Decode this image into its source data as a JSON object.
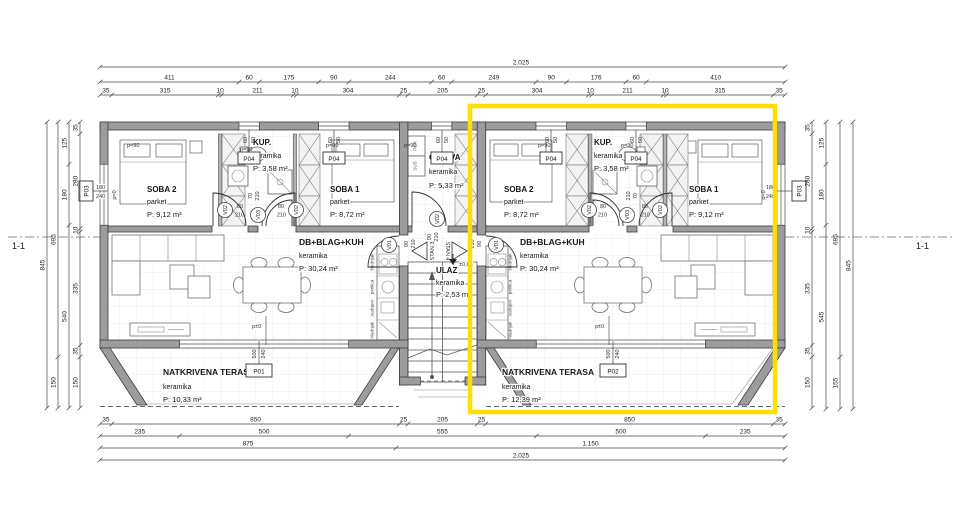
{
  "section": {
    "label": "1-1"
  },
  "highlight": {
    "color": "#ffdf00"
  },
  "rooms": {
    "l_soba2": {
      "name": "SOBA 2",
      "floor": "parket",
      "area": "P: 9,12 m²"
    },
    "l_kup": {
      "name": "KUP.",
      "floor": "keramika",
      "area": "P: 3,58 m²"
    },
    "l_soba1": {
      "name": "SOBA 1",
      "floor": "parket",
      "area": "P: 8,72 m²"
    },
    "l_living": {
      "name": "DB+BLAG+KUH",
      "floor": "keramika",
      "area": "P: 30,24 m²"
    },
    "l_terrace": {
      "name": "NATKRIVENA TERASA",
      "floor": "keramika",
      "area": "P: 10,33 m²"
    },
    "ostava": {
      "name": "OSTAVA",
      "floor": "keramika",
      "area": "P: 5,33 m²"
    },
    "ulaz": {
      "name": "ULAZ",
      "floor": "keramika",
      "area": "P: 2,53 m²"
    },
    "r_soba2": {
      "name": "SOBA 2",
      "floor": "parket",
      "area": "P: 8,72 m²"
    },
    "r_kup": {
      "name": "KUP.",
      "floor": "keramika",
      "area": "P: 3,58 m²"
    },
    "r_soba1": {
      "name": "SOBA 1",
      "floor": "parket",
      "area": "P: 9,12 m²"
    },
    "r_living": {
      "name": "DB+BLAG+KUH",
      "floor": "keramika",
      "area": "P: 30,24 m²"
    },
    "r_terrace": {
      "name": "NATKRIVENA TERASA",
      "floor": "keramika",
      "area": "P: 12,39 m²"
    }
  },
  "stairs": {
    "stan3": "STAN 3",
    "stan4": "STAN 4",
    "level": "±0,05"
  },
  "openings": {
    "p04": "P04",
    "p03": "P03",
    "p01": "P01",
    "p02": "P02",
    "p04_w": "60",
    "p04_h": "50",
    "p03_w": "180",
    "p03_h": "240",
    "ter_w": "500",
    "ter_h": "240",
    "parapet90": "p=90",
    "parapet0": "p=0",
    "level0": "p±0",
    "v01": "V01",
    "v02": "V02",
    "v03": "V03",
    "d70": "70",
    "d80": "80",
    "d90": "90",
    "d210": "210"
  },
  "utility": {
    "per": "PER",
    "sus": "SUŠ"
  },
  "kitchen": {
    "stove": "štednjak",
    "washer": "perilica",
    "sink": "sudoper",
    "fridge": "hladnjak"
  },
  "dims": {
    "top1": [
      "2.025"
    ],
    "top2": [
      "411",
      "60",
      "175",
      "90",
      "244",
      "60",
      "249",
      "90",
      "176",
      "60",
      "410"
    ],
    "top3": [
      "35",
      "315",
      "10",
      "211",
      "10",
      "304",
      "25",
      "205",
      "25",
      "304",
      "10",
      "211",
      "10",
      "315",
      "35"
    ],
    "bottom1": [
      "35",
      "850",
      "25",
      "205",
      "25",
      "850",
      "35"
    ],
    "bottom2": [
      "235",
      "500",
      "555",
      "500",
      "235"
    ],
    "bottom3": [
      "875",
      "1.150"
    ],
    "bottom4": [
      "2.025"
    ],
    "left1": [
      "35",
      "280",
      "10",
      "335",
      "35",
      "150"
    ],
    "left2": [
      "125",
      "180",
      "540"
    ],
    "left3": [
      "695",
      "150"
    ],
    "left4": [
      "845"
    ],
    "right1": [
      "35",
      "280",
      "10",
      "335",
      "35",
      "150"
    ],
    "right2": [
      "125",
      "180",
      "545"
    ],
    "right3": [
      "695",
      "155"
    ],
    "right4": [
      "845"
    ]
  }
}
